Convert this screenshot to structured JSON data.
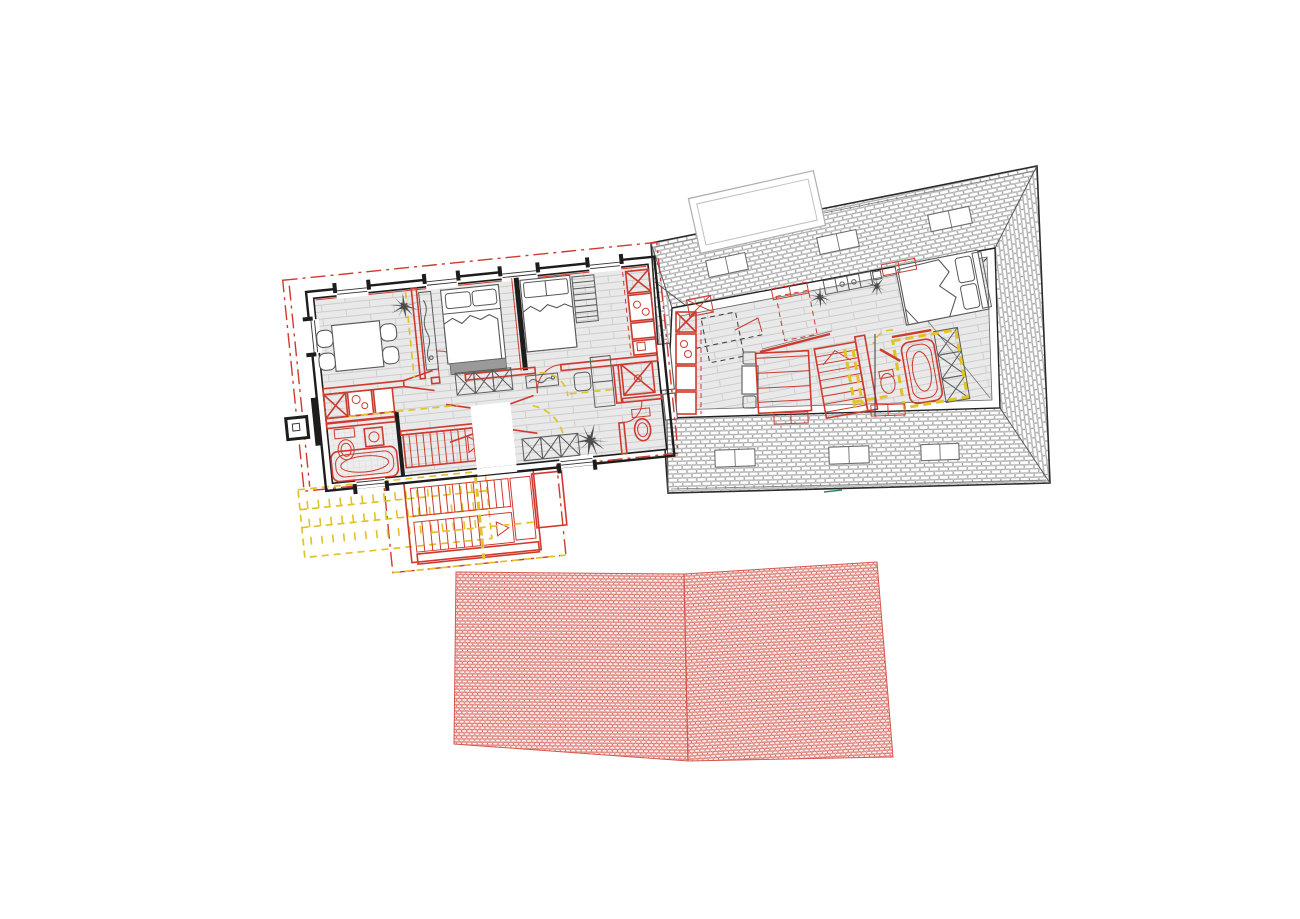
{
  "meta": {
    "description": "Architectural renovation drawing: tilted ground-floor plan with red new-work and yellow demolition markings, attic plan with hatched hip-roof bands and skylights, and two red roof-tile elevation panels"
  },
  "colors": {
    "wall": "#1d1d1d",
    "red": "#cf3a2e",
    "redSoft": "#d4574e",
    "tileFill": "#fdf0ee",
    "yellow": "#e2c229",
    "floor": "#e9e9e9",
    "floorLine": "#cdcdcd",
    "roofFill": "#f7f7f7",
    "roofLine": "#8f8f8f",
    "darkItem": "#4a4a4a",
    "grayFill": "#9a9a9a",
    "green": "#2e8b57"
  },
  "attic": {
    "skylights": [
      {
        "cx": 727,
        "cy": 265,
        "w": 40,
        "h": 17,
        "rot": -12
      },
      {
        "cx": 838,
        "cy": 242,
        "w": 40,
        "h": 17,
        "rot": -12
      },
      {
        "cx": 950,
        "cy": 219,
        "w": 42,
        "h": 17,
        "rot": -12
      },
      {
        "cx": 735,
        "cy": 458,
        "w": 40,
        "h": 17,
        "rot": -2
      },
      {
        "cx": 849,
        "cy": 455,
        "w": 40,
        "h": 17,
        "rot": -2
      },
      {
        "cx": 940,
        "cy": 452,
        "w": 38,
        "h": 16,
        "rot": -2
      }
    ],
    "window_markers": [
      {
        "cx": 700,
        "cy": 306,
        "w": 24,
        "h": 17,
        "rot": -11,
        "t": "x"
      },
      {
        "cx": 790,
        "cy": 291,
        "w": 36,
        "h": 11,
        "rot": -11,
        "t": "p"
      },
      {
        "cx": 899,
        "cy": 267,
        "w": 34,
        "h": 11,
        "rot": -11,
        "t": "p"
      },
      {
        "cx": 791,
        "cy": 418,
        "w": 34,
        "h": 11,
        "rot": -2,
        "t": "p"
      },
      {
        "cx": 888,
        "cy": 410,
        "w": 34,
        "h": 11,
        "rot": -2,
        "t": "p"
      }
    ],
    "plants": [
      {
        "x": 820,
        "y": 297,
        "s": 1.0,
        "rot": 0
      },
      {
        "x": 877,
        "y": 286,
        "s": 0.9,
        "rot": 40
      }
    ]
  },
  "left_plan": {
    "plants": [
      {
        "x": 96,
        "y": 24,
        "s": 1.2,
        "rot": 0
      },
      {
        "x": 268,
        "y": 176,
        "s": 1.5,
        "rot": 20
      }
    ],
    "terrace": {
      "rows": [
        208,
        226,
        244
      ],
      "x0": -20,
      "x1": 150,
      "step": 11,
      "len": 8
    }
  }
}
